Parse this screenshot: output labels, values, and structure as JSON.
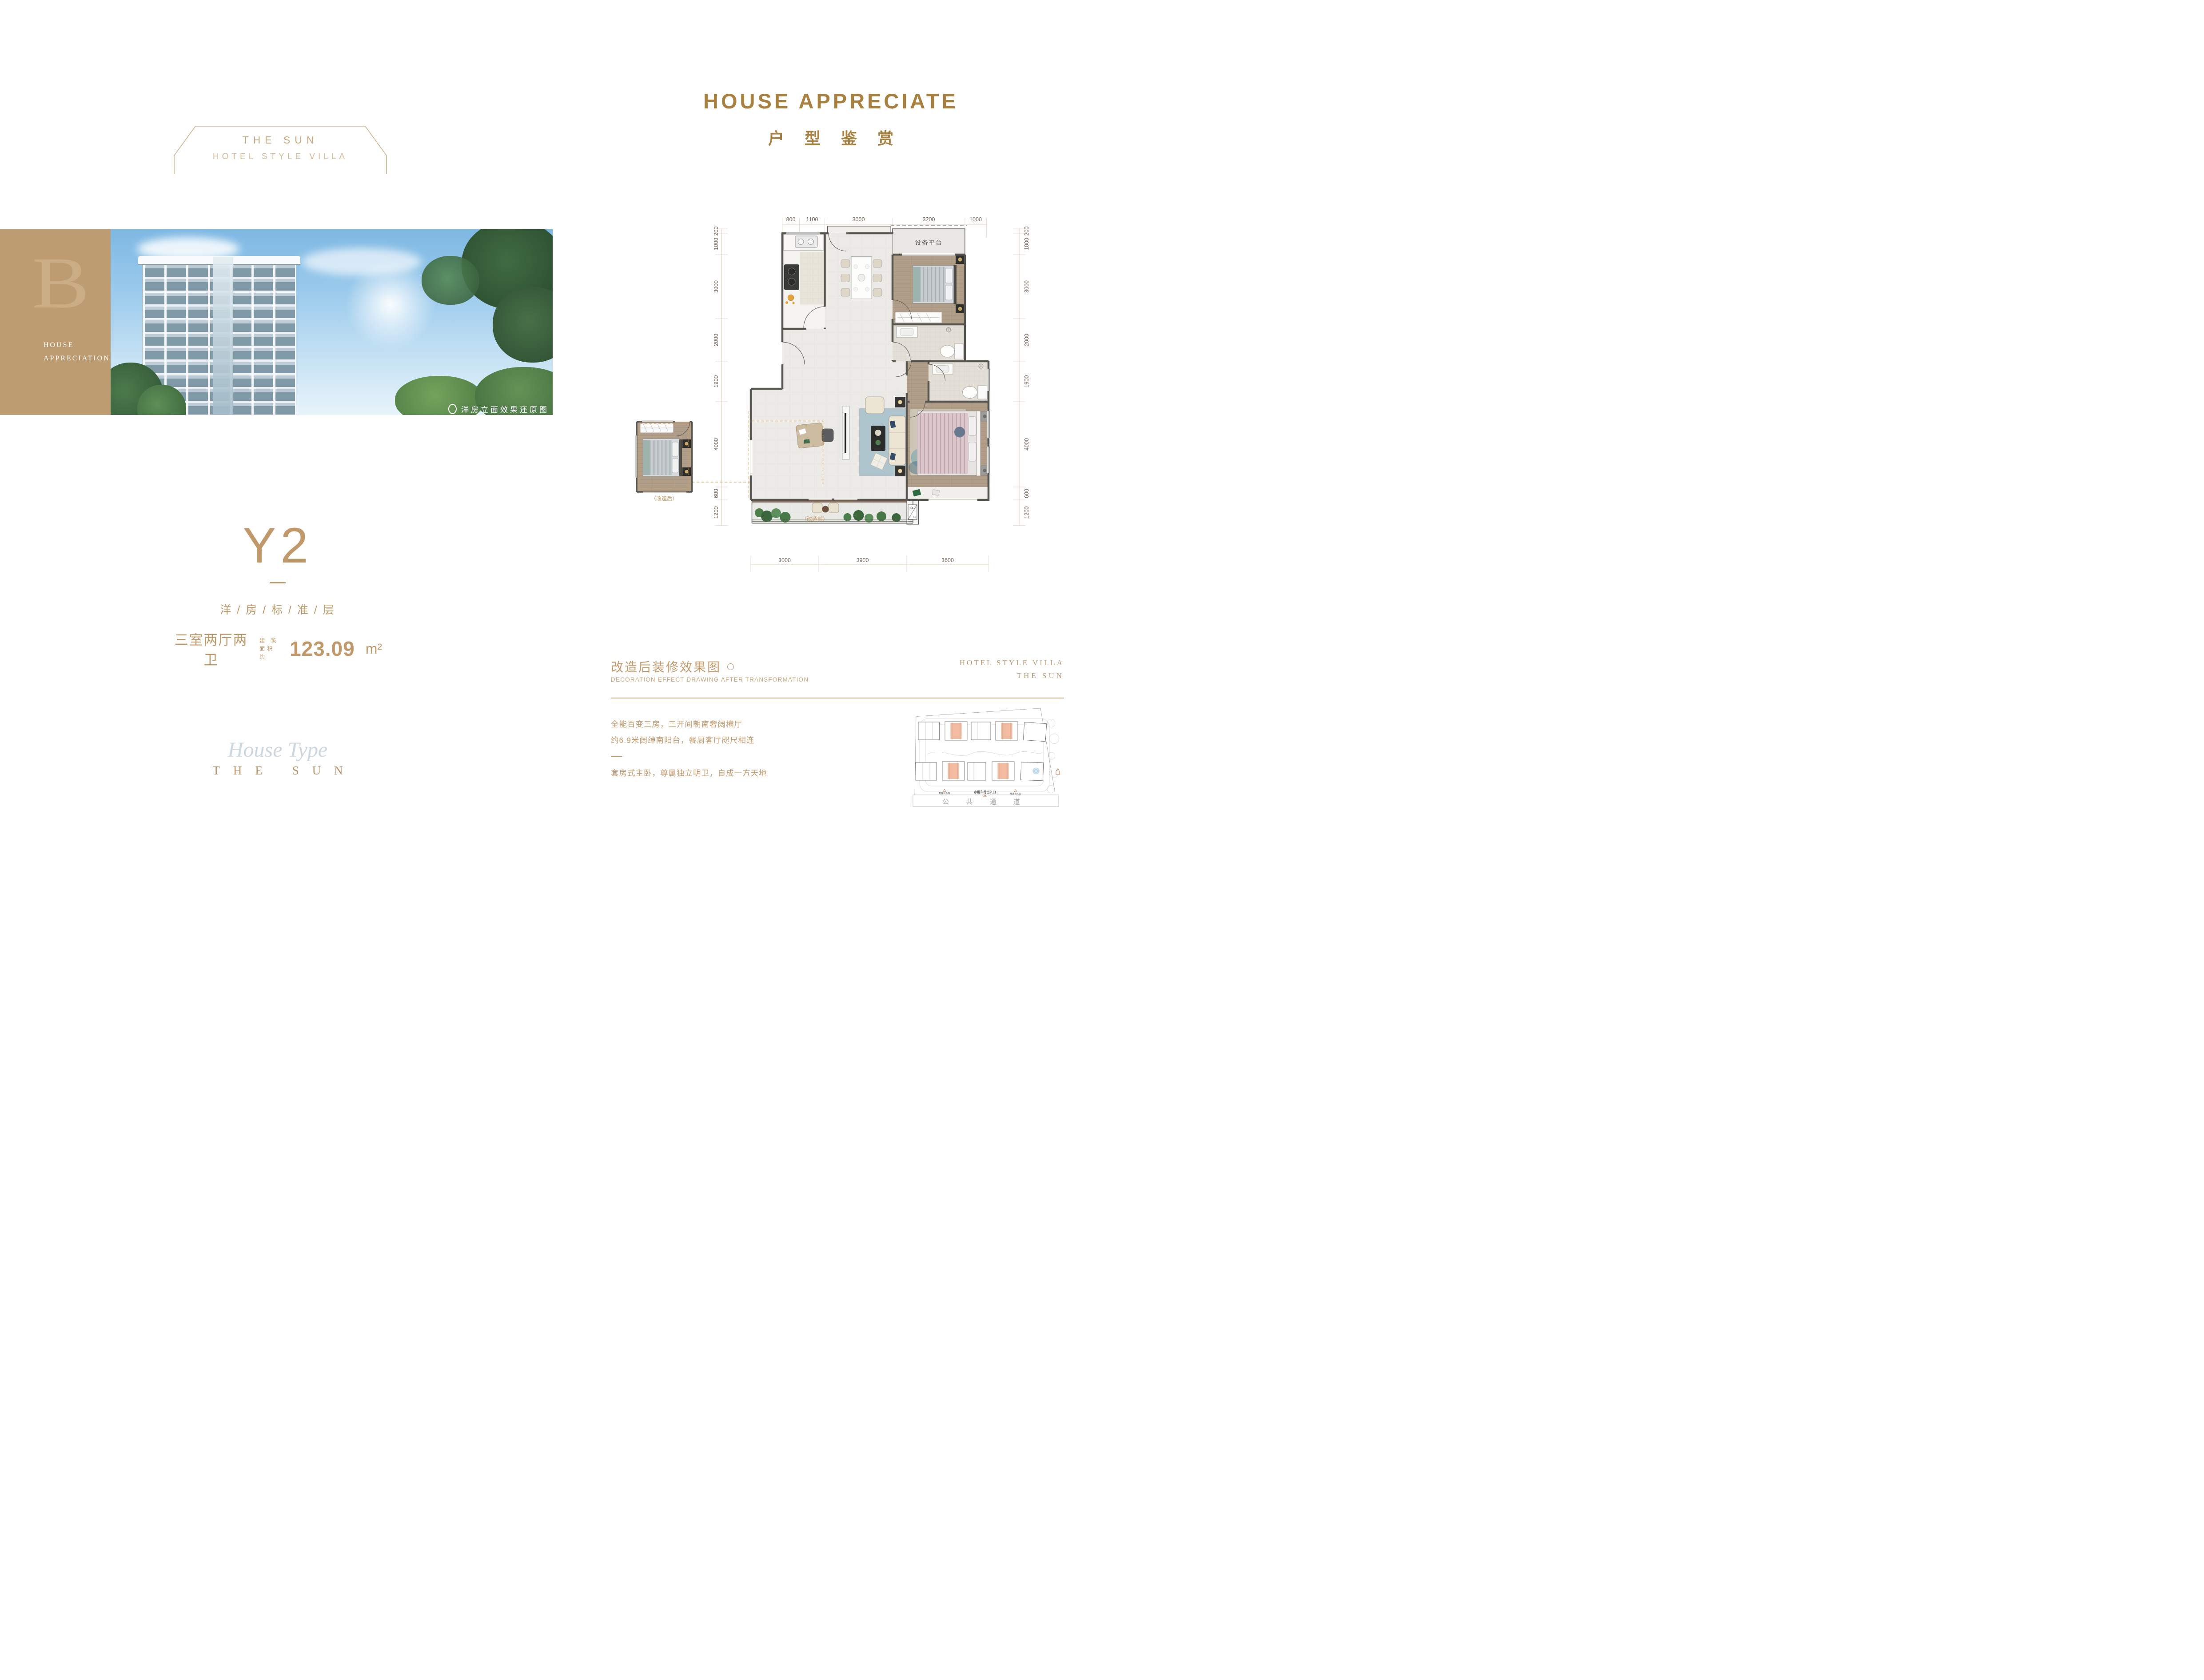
{
  "badge": {
    "line1": "THE SUN",
    "line2": "HOTEL STYLE VILLA"
  },
  "side_block": {
    "monogram": "B",
    "line1": "HOUSE",
    "line2": "APPRECIATION"
  },
  "photo": {
    "caption": "洋房立面效果还原图"
  },
  "unit": {
    "code": "Y2",
    "category": "洋 / 房 / 标 / 准 / 层",
    "rooms": "三室两厅两卫",
    "area_label_1": "建 筑",
    "area_label_2": "面积约",
    "area_value": "123.09",
    "area_unit": "m²"
  },
  "footer_mark": {
    "script": "House Type",
    "brand": "THE SUN"
  },
  "right_title": {
    "en": "HOUSE APPRECIATE",
    "cn": "户 型 鉴 赏"
  },
  "plan": {
    "dims_top": [
      "800",
      "1100",
      "3000",
      "3200",
      "1000"
    ],
    "dims_bottom": [
      "3000",
      "3900",
      "3600"
    ],
    "dims_left": [
      "200",
      "1000",
      "3000",
      "2000",
      "1900",
      "4000",
      "600",
      "1200"
    ],
    "dims_right": [
      "200",
      "1000",
      "3000",
      "2000",
      "1900",
      "4000",
      "600",
      "1200"
    ],
    "labels": {
      "equipment": "设备平台",
      "before": "（改造前）",
      "after": "（改造后）",
      "ac_top": "2A",
      "ac_bottom": "C"
    }
  },
  "note": {
    "cn": "改造后装修效果图",
    "en": "DECORATION EFFECT DRAWING AFTER TRANSFORMATION"
  },
  "brand_right": {
    "line1": "HOTEL STYLE VILLA",
    "line2": "THE SUN"
  },
  "description": {
    "line1": "全能百变三房，三开间朝南奢阔横厅",
    "line2": "约6.9米阔绰南阳台，餐厨客厅咫尺相连",
    "line3": "套房式主卧，尊属独立明卫，自成一方天地"
  },
  "site_plan": {
    "road": "公 共 通 道",
    "entrance": "小区车行出入口",
    "garage_left": "地库出入口",
    "garage_right": "地库出入口"
  },
  "colors": {
    "accent": "#bf996a",
    "title_gold": "#a8803f",
    "block_tan": "#bd9c72",
    "dim_text": "#6f6154",
    "dim_line": "#d3bd9c",
    "highlight_salmon": "#f3bb9f",
    "wall": "#56544e"
  }
}
